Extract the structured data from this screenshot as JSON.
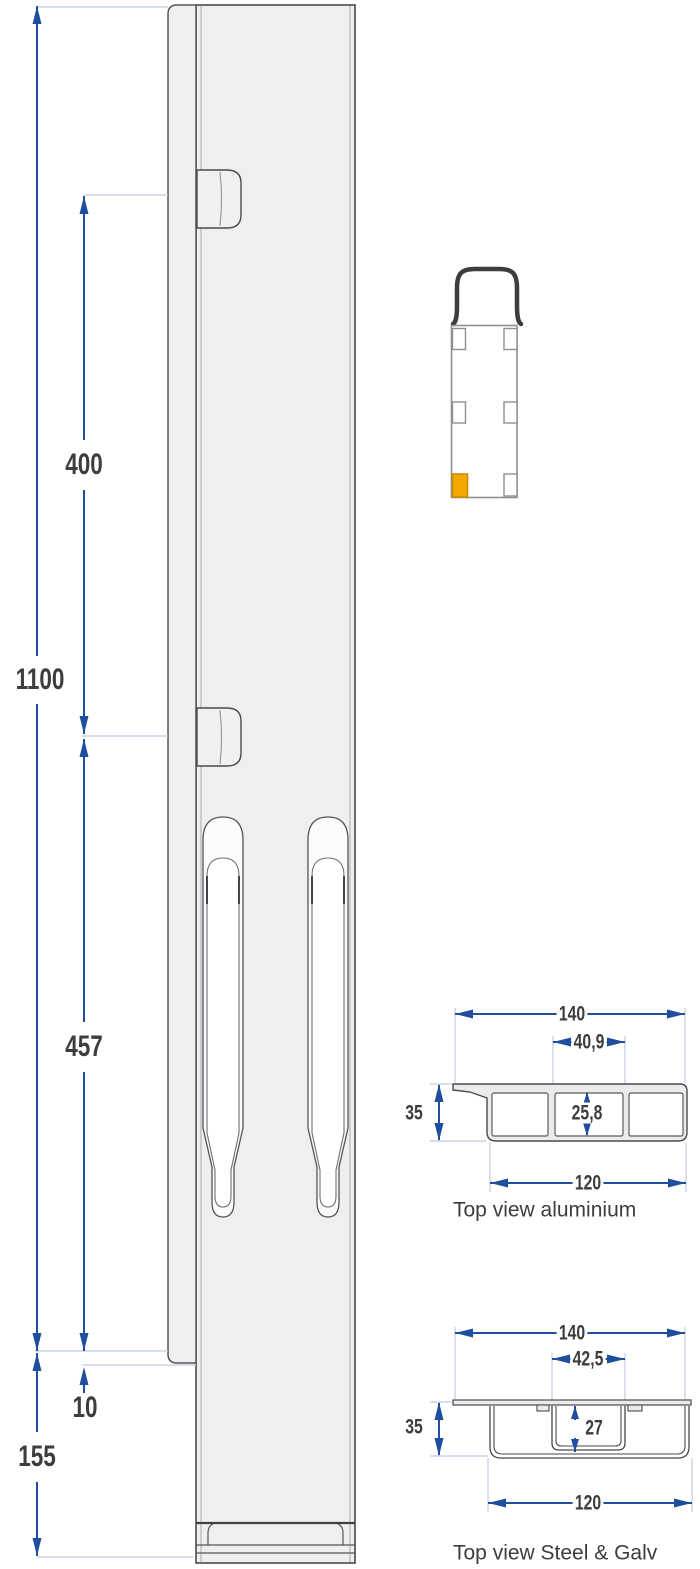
{
  "colors": {
    "dimension_blue": "#1f4e9e",
    "extension_line": "#c2cbe3",
    "outline_gray": "#4a4a4e",
    "fill_gray": "#efeff0",
    "highlight_orange": "#f5a800",
    "text": "#3d3d40"
  },
  "side_view": {
    "dims": {
      "overall": "1100",
      "upper": "400",
      "slot": "457",
      "offset": "10",
      "base": "155"
    }
  },
  "locator": {
    "highlight_color": "#f5a800"
  },
  "aluminium": {
    "caption": "Top view aluminium",
    "dims": {
      "overall": "140",
      "slot": "40,9",
      "height": "35",
      "inner": "25,8",
      "body": "120"
    }
  },
  "steel": {
    "caption": "Top view Steel & Galv",
    "dims": {
      "overall": "140",
      "slot": "42,5",
      "height": "35",
      "inner": "27",
      "body": "120"
    }
  }
}
